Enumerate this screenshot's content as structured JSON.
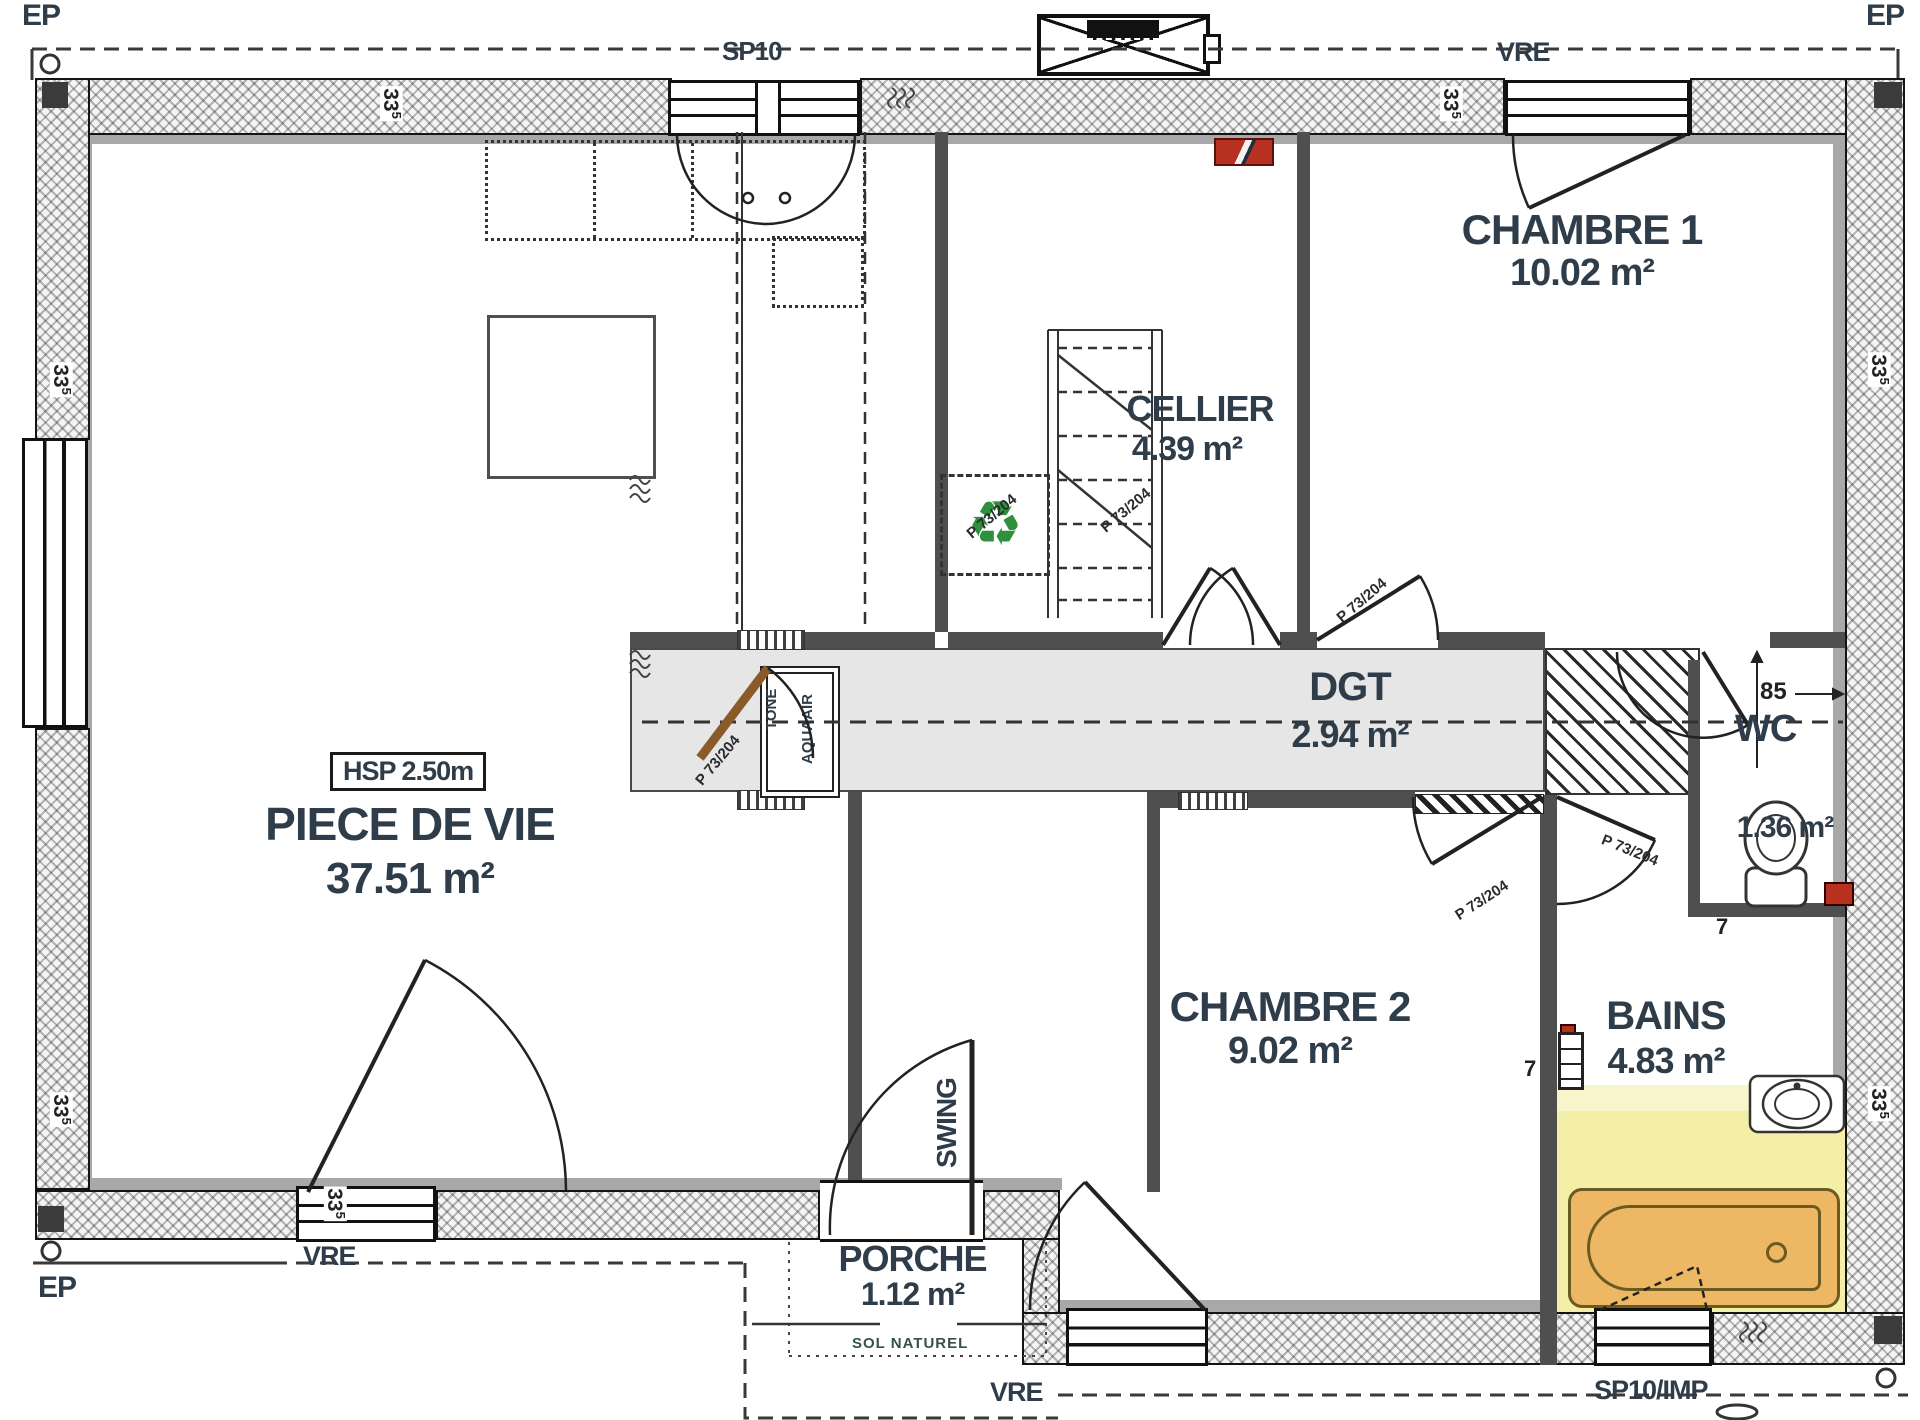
{
  "exterior_labels": {
    "ep": "EP",
    "sp10": "SP10",
    "vre": "VRE",
    "sp10imp": "SP10/IMP"
  },
  "rooms": {
    "piece_de_vie": {
      "name": "PIECE DE VIE",
      "area": "37.51 m²",
      "ceiling": "HSP 2.50m"
    },
    "cellier": {
      "name": "CELLIER",
      "area": "4.39 m²"
    },
    "chambre1": {
      "name": "CHAMBRE 1",
      "area": "10.02 m²"
    },
    "dgt": {
      "name": "DGT",
      "area": "2.94 m²"
    },
    "chambre2": {
      "name": "CHAMBRE 2",
      "area": "9.02 m²"
    },
    "bains": {
      "name": "BAINS",
      "area": "4.83 m²"
    },
    "wc": {
      "name": "WC",
      "area": "1.36 m²"
    },
    "porche": {
      "name": "PORCHE",
      "area": "1.12 m²"
    }
  },
  "annotations": {
    "door_spec": "P 73/204",
    "entry_door": "SWING",
    "ground": "SOL NATUREL",
    "stove_line1": "TONE",
    "stove_line2": "AQUAAIR",
    "dim_wall": "33",
    "dim_wall_sup": "5",
    "dim_wc": "85",
    "dim_small": "7",
    "recycle_icon": "♻"
  },
  "colors": {
    "wall": "#4f4f4f",
    "corridor_fill": "#e6e6e6",
    "bain_floor": "#f3efa6",
    "bathtub": "#edb763",
    "accent_red": "#b8301f",
    "recycle_green": "#2f8f3c",
    "door_wood": "#8a5a28",
    "text": "#2e3d49"
  }
}
